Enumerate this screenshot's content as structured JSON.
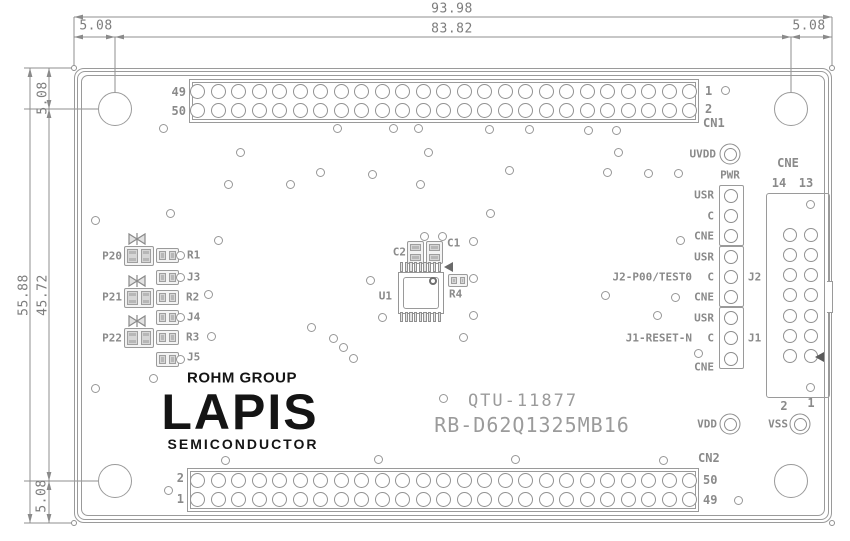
{
  "colors": {
    "line": "#9a9a9a",
    "cad_text": "#8a8a8a",
    "dim_text": "#7d7d7d",
    "logo_text": "#141414",
    "board_text": "#9b9b9b"
  },
  "dimensions": {
    "top_outer": "93.98",
    "top_inner": "83.82",
    "top_left": "5.08",
    "top_right": "5.08",
    "left_outer": "55.88",
    "left_inner": "45.72",
    "left_top": "5.08",
    "left_bottom": "5.08"
  },
  "cn1": {
    "name": "CN1",
    "rows": 2,
    "cols": 25,
    "top_left": "49",
    "bottom_left": "50",
    "top_right": "1",
    "bottom_right": "2"
  },
  "cn2": {
    "name": "CN2",
    "rows": 2,
    "cols": 25,
    "top_left": "2",
    "bottom_left": "1",
    "top_right": "50",
    "bottom_right": "49"
  },
  "cne": {
    "name": "CNE",
    "rows": 7,
    "cols": 2,
    "col_left": "14",
    "col_right": "13",
    "bottom_left": "2",
    "bottom_right": "1"
  },
  "testpoints": {
    "uvdd": "UVDD",
    "pwr": "PWR",
    "vdd": "VDD",
    "vss": "VSS"
  },
  "jumper_block": {
    "row_labels": [
      "USR",
      "C",
      "CNE",
      "USR",
      "C",
      "CNE",
      "USR",
      "C",
      "CNE"
    ],
    "j2_ref": "J2",
    "j2_net": "J2-P00/TEST0",
    "j1_ref": "J1",
    "j1_net": "J1-RESET-N"
  },
  "left_components": {
    "leds": [
      "P20",
      "P21",
      "P22"
    ],
    "rows": [
      "R1",
      "J3",
      "R2",
      "J4",
      "R3",
      "J5"
    ]
  },
  "center": {
    "ic": "U1",
    "c1": "C1",
    "c2": "C2",
    "r4": "R4"
  },
  "logo": {
    "group": "ROHM GROUP",
    "name": "LAPIS",
    "sub": "SEMICONDUCTOR"
  },
  "board_text": {
    "line1": "QTU-11877",
    "line2": "RB-D62Q1325MB16"
  },
  "vias": [
    [
      725,
      90
    ],
    [
      163,
      128
    ],
    [
      337,
      128
    ],
    [
      393,
      128
    ],
    [
      418,
      128
    ],
    [
      489,
      129
    ],
    [
      529,
      129
    ],
    [
      588,
      130
    ],
    [
      616,
      130
    ],
    [
      240,
      152
    ],
    [
      428,
      152
    ],
    [
      618,
      152
    ],
    [
      320,
      172
    ],
    [
      372,
      174
    ],
    [
      509,
      170
    ],
    [
      607,
      172
    ],
    [
      648,
      173
    ],
    [
      678,
      173
    ],
    [
      228,
      184
    ],
    [
      290,
      184
    ],
    [
      420,
      184
    ],
    [
      95,
      220
    ],
    [
      170,
      213
    ],
    [
      490,
      213
    ],
    [
      218,
      240
    ],
    [
      424,
      236
    ],
    [
      442,
      236
    ],
    [
      473,
      241
    ],
    [
      680,
      240
    ],
    [
      180,
      255
    ],
    [
      180,
      277
    ],
    [
      208,
      294
    ],
    [
      180,
      317
    ],
    [
      211,
      336
    ],
    [
      180,
      359
    ],
    [
      370,
      280
    ],
    [
      473,
      278
    ],
    [
      605,
      295
    ],
    [
      675,
      297
    ],
    [
      657,
      315
    ],
    [
      698,
      353
    ],
    [
      311,
      327
    ],
    [
      333,
      338
    ],
    [
      343,
      347
    ],
    [
      353,
      358
    ],
    [
      382,
      317
    ],
    [
      473,
      315
    ],
    [
      463,
      337
    ],
    [
      153,
      378
    ],
    [
      95,
      388
    ],
    [
      443,
      398
    ],
    [
      225,
      460
    ],
    [
      378,
      459
    ],
    [
      515,
      459
    ],
    [
      663,
      460
    ],
    [
      168,
      490
    ],
    [
      738,
      500
    ],
    [
      810,
      204
    ],
    [
      810,
      387
    ]
  ]
}
